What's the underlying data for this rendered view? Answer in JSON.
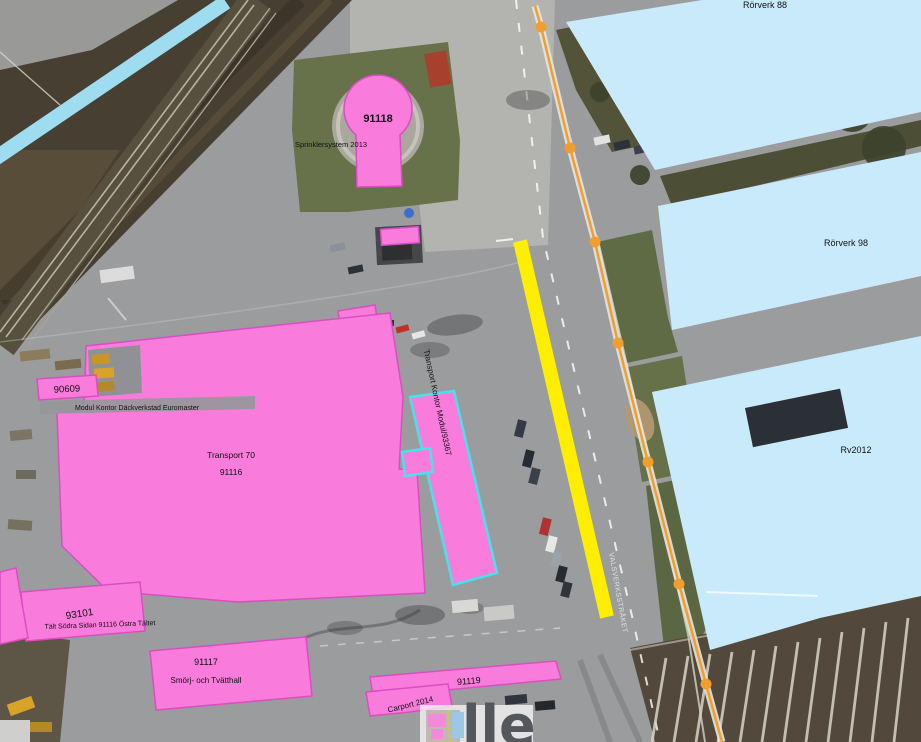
{
  "map": {
    "type": "aerial-facility-map",
    "labels": {
      "rorverk88": "Rörverk 88",
      "rorverk98": "Rörverk 98",
      "rv2012": "Rv2012",
      "n91118": "91118",
      "sprinkler": "Sprinklersystem 2013",
      "n90609": "90609",
      "euromaster": "Modul Kontor Däckverkstad Euromaster",
      "transport70": "Transport 70",
      "n91116": "91116",
      "modul93367": "Transport Kontor Modul/93367",
      "n93101": "93101",
      "talt": "Tält Södra Sidan 91116 Östra Tältet",
      "n91117": "91117",
      "smorj": "Smörj- och Tvätthall",
      "n91119": "91119",
      "carport": "Carport 2014",
      "street": "VALSVERKSSTRÅKET",
      "watermark": "lle"
    },
    "colors": {
      "building_pink": "#f97cdc",
      "pink_stroke": "#da4ec2",
      "building_blue": "#c9eafb",
      "highlight_yellow": "#ffee00",
      "utility_orange": "#f09f2e",
      "selected_cyan": "#47e2ec",
      "stream_blue": "#9edcf0"
    }
  }
}
